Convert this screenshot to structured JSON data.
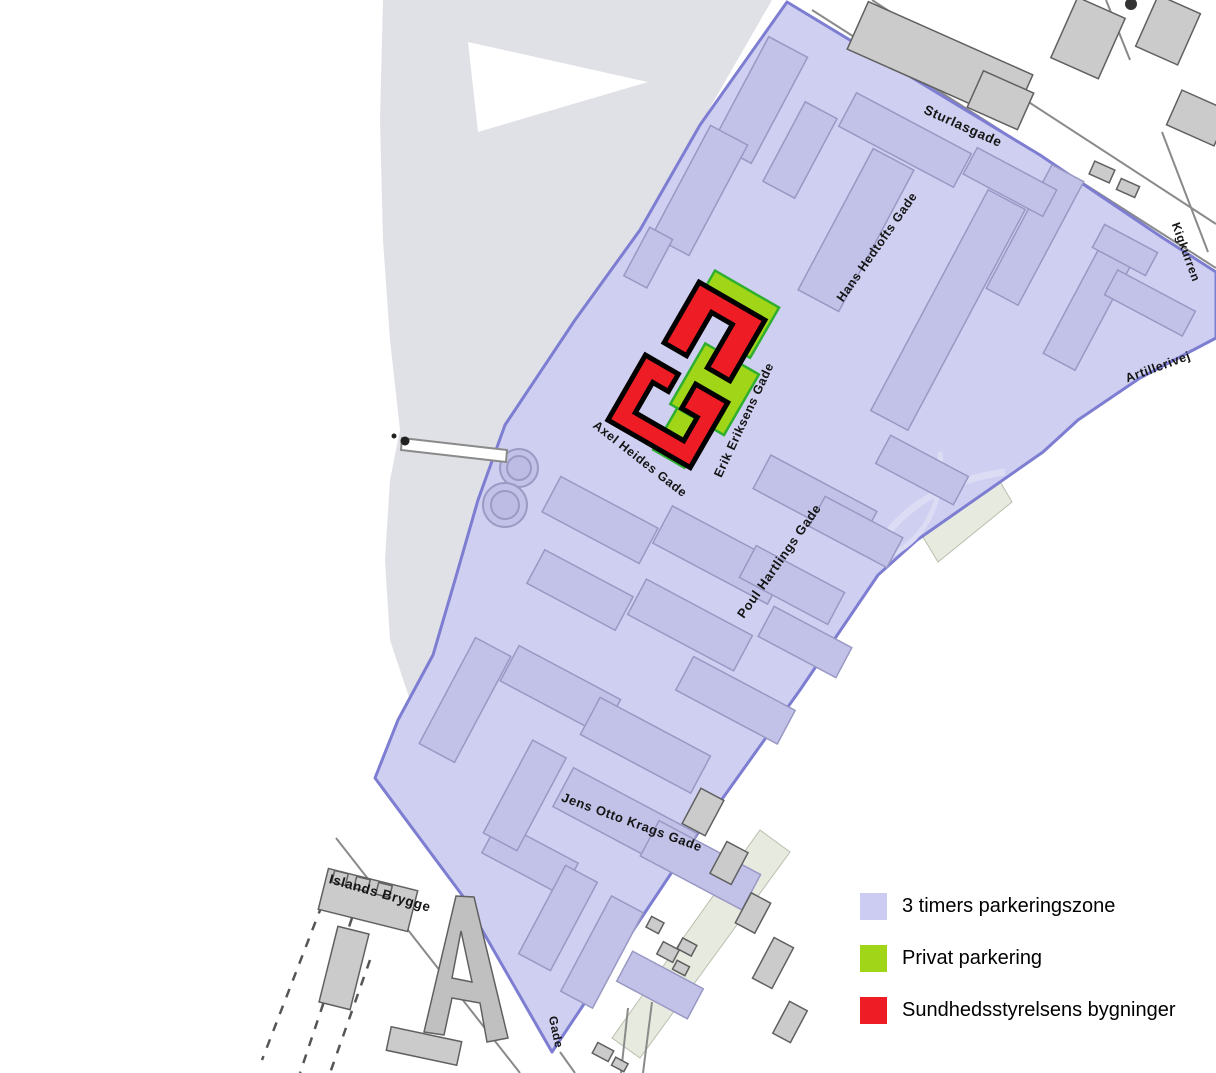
{
  "map": {
    "description": "Parking zone map, Islands Brygge area",
    "streets": [
      {
        "name": "Sturlasgade"
      },
      {
        "name": "Kigkurren"
      },
      {
        "name": "Artillerivej"
      },
      {
        "name": "Hans Hedtofts Gade"
      },
      {
        "name": "Erik Eriksens Gade"
      },
      {
        "name": "Axel Heides Gade"
      },
      {
        "name": "Poul Hartlings Gade"
      },
      {
        "name": "Jens Otto Krags Gade"
      },
      {
        "name": "Islands Brygge"
      },
      {
        "name": "Gade"
      }
    ],
    "colors": {
      "water": "#e0e0e7",
      "zone_fill": "#cfcff1",
      "zone_border": "#7d7dd1",
      "building_in_zone": "#c2c2e8",
      "building_in_zone_outline": "#9898c4",
      "building_outside": "#cbcbcb",
      "building_outside_outline": "#606060",
      "private_parking": "#a0d518",
      "private_parking_outline": "#2faf2f",
      "sundhedsstyrelsen": "#ee1c25",
      "sundhedsstyrelsen_outline": "#000000",
      "roadside_strip": "#e7ebdf",
      "street_line": "#8a8a8a"
    },
    "legend": {
      "items": [
        {
          "label": "3 timers parkeringszone",
          "color": "#ccccf2"
        },
        {
          "label": "Privat parkering",
          "color": "#a0d518"
        },
        {
          "label": "Sundhedsstyrelsens bygninger",
          "color": "#ee1c25"
        }
      ]
    }
  }
}
